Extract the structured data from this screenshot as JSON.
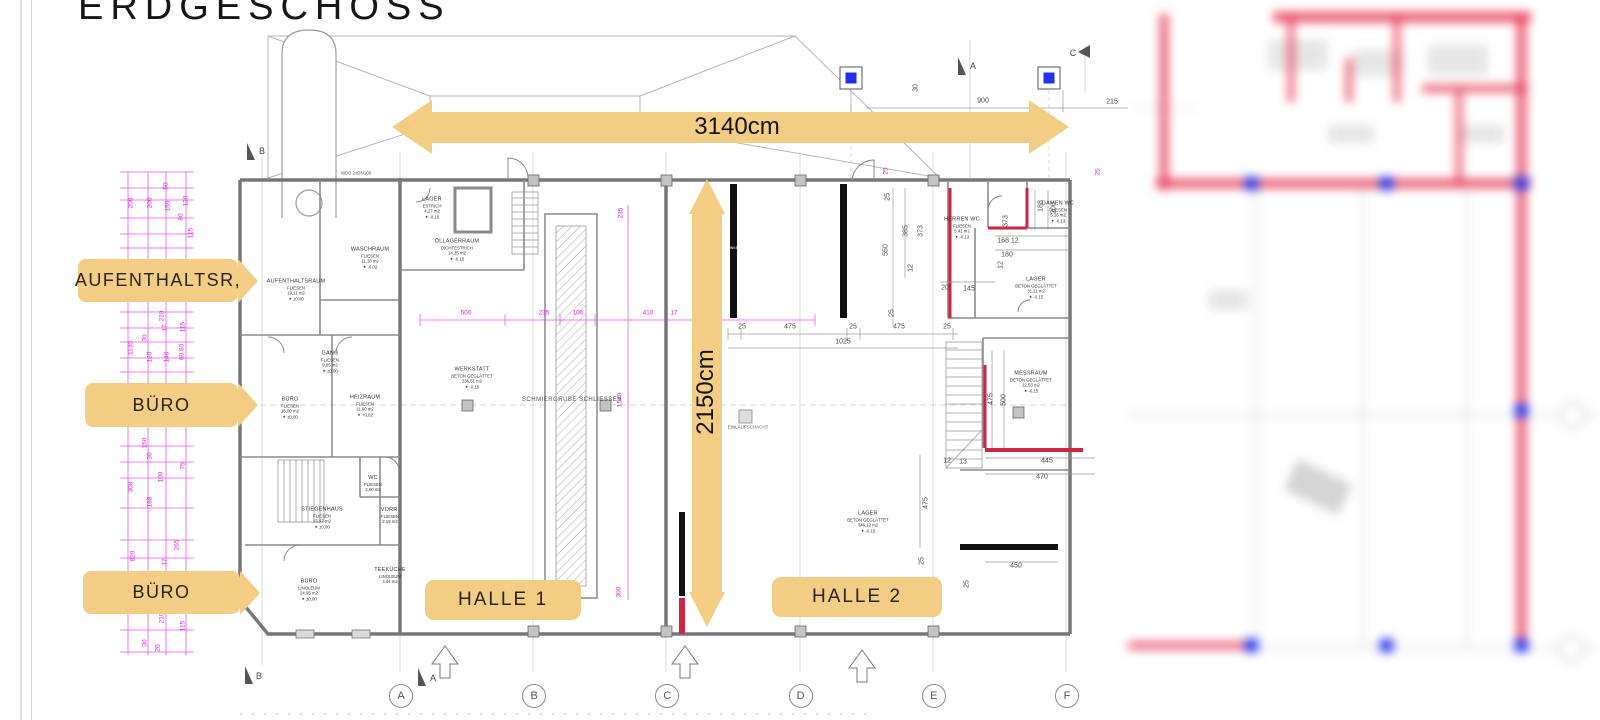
{
  "title": "ERDGESCHOSS",
  "colors": {
    "annotation_tan": "#f3cd84",
    "dimension_magenta": "#d926d9",
    "wall_red": "#cf2540",
    "node_blue": "#2330ee"
  },
  "annotations": {
    "width_arrow_label": "3140cm",
    "height_arrow_label": "2150cm",
    "flags": [
      "AUFENTHALTSR,",
      "BÜRO",
      "BÜRO"
    ],
    "halls": [
      "HALLE 1",
      "HALLE 2"
    ]
  },
  "plan": {
    "rooms": [
      {
        "name": "AUFENTHALTSRAUM",
        "finish": "FLIESEN",
        "area": "19,11 m2",
        "level": "±0,00"
      },
      {
        "name": "WASCHRAUM",
        "finish": "FLIESEN",
        "area": "11,18 m2",
        "level": "-0,02"
      },
      {
        "name": "LAGER",
        "finish": "ESTRICH",
        "area": "4,27 m2",
        "level": "-0,16"
      },
      {
        "name": "ÖLLAGERRAUM",
        "finish": "DICHTESTRICH",
        "area": "14,35 m2",
        "level": "-0,15"
      },
      {
        "name": "GANG",
        "finish": "FLIESEN",
        "area": "9,05 m2",
        "level": "±0,00"
      },
      {
        "name": "BÜRO",
        "finish": "FLIESEN",
        "area": "16,00 m2",
        "level": "±0,00"
      },
      {
        "name": "HEIZRAUM",
        "finish": "FLIESEN",
        "area": "11,60 m2",
        "level": "+0,02"
      },
      {
        "name": "WC",
        "finish": "FLIESEN",
        "area": "2,60 m2",
        "level": ""
      },
      {
        "name": "STIEGENHAUS",
        "finish": "FLIESEN",
        "area": "13,97 m2",
        "level": "±0,00"
      },
      {
        "name": "VORR.",
        "finish": "FLIESEN",
        "area": "2,18 m2",
        "level": ""
      },
      {
        "name": "BÜRO",
        "finish": "LINOLEUM",
        "area": "24,95 m2",
        "level": "±0,00"
      },
      {
        "name": "TEEKÜCHE",
        "finish": "LINOLEUM",
        "area": "3,04 m2",
        "level": ""
      },
      {
        "name": "WERKSTATT",
        "finish": "BETON GEGLÄTTET",
        "area": "236,51 m2",
        "level": "-0,15"
      },
      {
        "name": "LAGER",
        "finish": "BETON GEGLÄTTET",
        "area": "346,12 m2",
        "level": "-0,15"
      },
      {
        "name": "HERREN WC",
        "finish": "FLIESEN",
        "area": "5,41 m2",
        "level": "-0,13"
      },
      {
        "name": "DAMEN WC",
        "finish": "FLIESEN",
        "area": "5,16 m2",
        "level": "-0,13"
      },
      {
        "name": "LAGER",
        "finish": "BETON GEGLÄTTET",
        "area": "31,11 m2",
        "level": "-0,15"
      },
      {
        "name": "MESSRAUM",
        "finish": "BETON GEGLÄTTET",
        "area": "22,53 m2",
        "level": "-0,15"
      }
    ],
    "features": {
      "schmiergrube": "SCHMIERGRUBE SCHLIESSEN",
      "einlaufschacht": "EINLAUFSCHACHT",
      "wdb": "WDB 2xDN100",
      "klinker": "KLINKER"
    },
    "grid_letters": [
      "A",
      "B",
      "C",
      "D",
      "E",
      "F"
    ],
    "section_markers": [
      "B",
      "A",
      "C",
      "B",
      "A"
    ],
    "dims": {
      "top": [
        "30",
        "900",
        "215"
      ],
      "h2_bottom": [
        "25",
        "475",
        "25",
        "475",
        "25",
        "1025"
      ],
      "h2_left": [
        "25",
        "550",
        "385",
        "373",
        "12",
        "25"
      ],
      "wc": [
        "188",
        "200",
        "168 12",
        "180",
        "20",
        "145",
        "373",
        "12"
      ],
      "mess": [
        "475",
        "500",
        "445",
        "470",
        "12",
        "13",
        "450",
        "25",
        "475",
        "25"
      ],
      "magenta_plan": [
        "500",
        "235",
        "100",
        "410",
        "17",
        "235",
        "1540",
        "300",
        "25",
        "25"
      ],
      "left_chain": [
        "200",
        "200",
        "150",
        "120",
        "50",
        "80",
        "115",
        "1130",
        "30",
        "17",
        "210",
        "115",
        "120",
        "146",
        "60,60",
        "150",
        "30",
        "100",
        "168",
        "75",
        "308",
        "820",
        "265",
        "17",
        "210",
        "115",
        "30",
        "20"
      ]
    }
  }
}
